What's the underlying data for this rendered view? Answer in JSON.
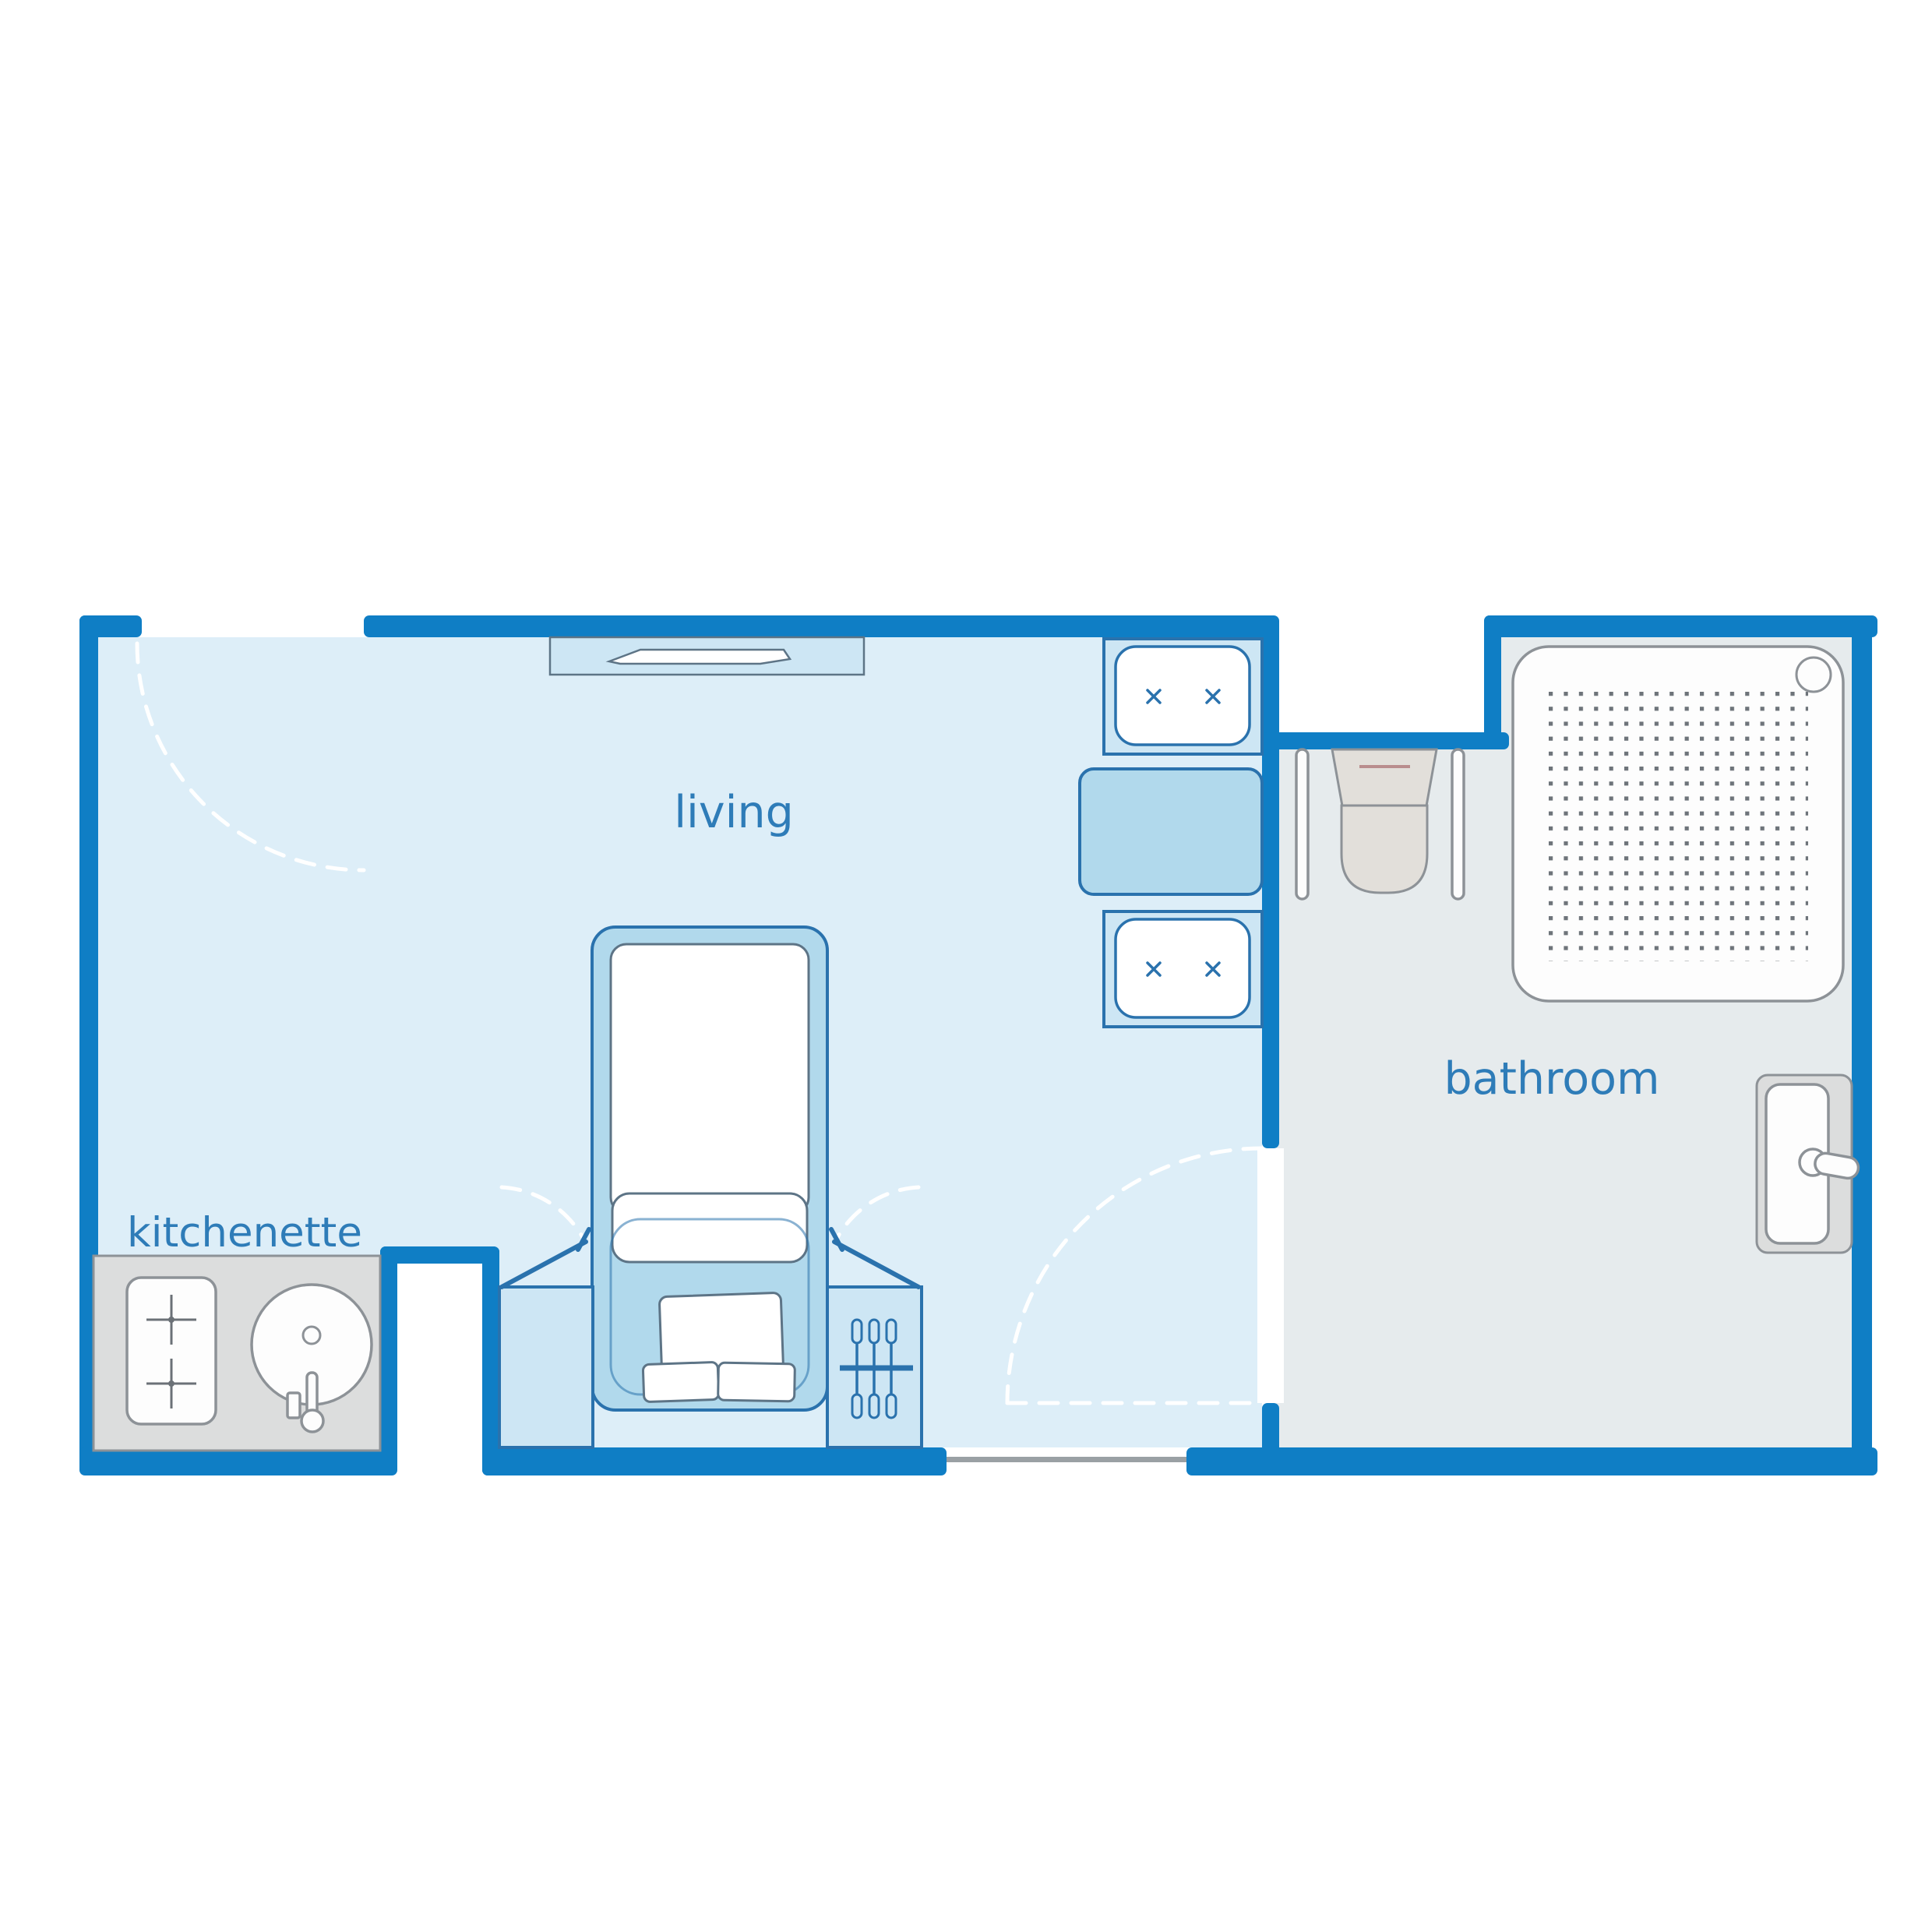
{
  "plan_title": "studio floor plan",
  "rooms": {
    "living": {
      "label": "living",
      "features": [
        "entry-door-swing",
        "radiator-under-window",
        "single-bed",
        "bedside-cabinet-left",
        "wardrobe-with-hangers-right",
        "cabinet-door-swings",
        "washbasin-unit-top",
        "cabinet-middle",
        "washbasin-unit-bottom",
        "window-opening-bottom"
      ]
    },
    "kitchenette": {
      "label": "kitchenette",
      "features": [
        "counter",
        "two-burner-cooktop",
        "round-sink-with-faucet"
      ]
    },
    "bathroom": {
      "label": "bathroom",
      "features": [
        "walk-in-shower-with-drain",
        "toilet-with-grab-bars",
        "washbasin-with-faucet",
        "door-swing"
      ]
    }
  },
  "colors": {
    "wall": "#0f7ec5",
    "living_floor": "#ddeef8",
    "bathroom_floor": "#e6ebed",
    "fixture_light_blue": "#cde6f4",
    "fixture_medium_blue": "#b1d9ec",
    "fixture_stroke_blue": "#2a72ad",
    "fixture_stroke_grey": "#8d9297",
    "counter_grey": "#dcdddd",
    "toilet_grey": "#e2dfda",
    "label_blue": "#2e7cb8",
    "swing_dash": "#ffffff",
    "shower_dot": "#6e747a",
    "window_line": "#9aa0a4",
    "tank_accent": "#b98d8d"
  }
}
